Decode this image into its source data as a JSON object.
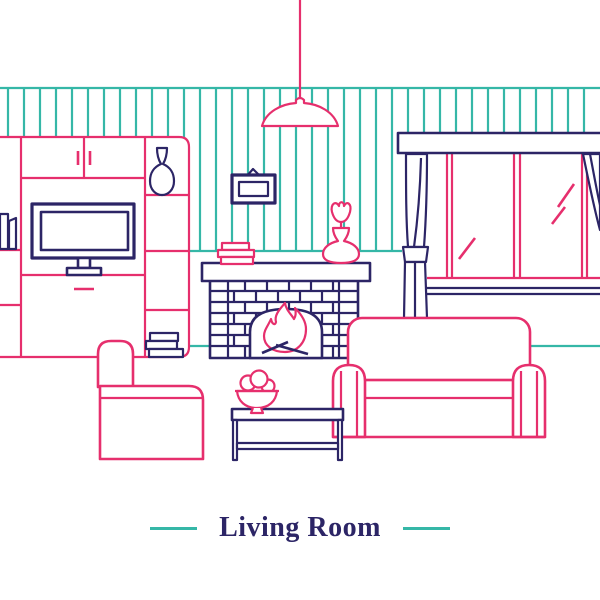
{
  "title": {
    "text": "Living Room"
  },
  "palette": {
    "pink": "#e62f6d",
    "navy": "#2c2566",
    "teal": "#35b7a7",
    "background": "#ffffff"
  },
  "scene": {
    "label": "living room line illustration",
    "objects": [
      "pendant-lamp",
      "striped-wallpaper",
      "wall-unit-with-tv",
      "tv",
      "decor-vase",
      "shelf-books",
      "picture-frame",
      "fireplace-with-fire",
      "mantel-books",
      "tulip-vase",
      "window",
      "curtains",
      "sofa",
      "armchair",
      "coffee-table",
      "fruit-bowl"
    ]
  }
}
